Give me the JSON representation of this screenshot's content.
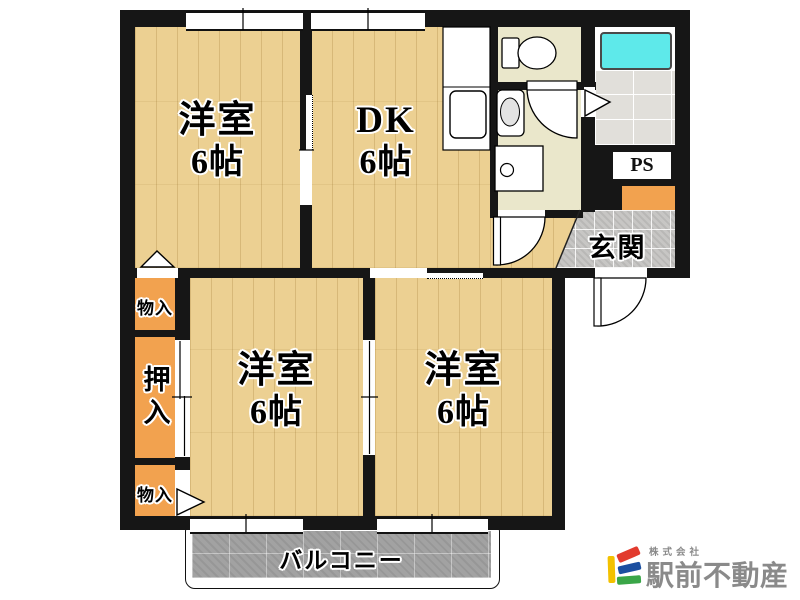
{
  "floor_plan": {
    "rooms": [
      {
        "name": "洋室",
        "size": "6帖",
        "position": "top-left"
      },
      {
        "name": "DK",
        "size": "6帖",
        "position": "top-center"
      },
      {
        "name": "洋室",
        "size": "6帖",
        "position": "bottom-left"
      },
      {
        "name": "洋室",
        "size": "6帖",
        "position": "bottom-center"
      }
    ],
    "entrance_label": "玄関",
    "closet_top_label": "物入",
    "closet_middle_label": "押入",
    "closet_bottom_label": "物入",
    "pipe_space_label": "PS",
    "balcony_label": "バルコニー"
  },
  "branding": {
    "company_prefix": "株式会社",
    "company_name": "駅前不動産",
    "name_color": "#8a8a8a",
    "mark_colors": {
      "yellow": "#f3c100",
      "red": "#e23b2e",
      "blue": "#1b4fa0",
      "green": "#3aa648"
    }
  },
  "palette": {
    "wood_floor": "#ecd092",
    "closet_orange": "#f2a24f",
    "sanitary_beige": "#eae7cb",
    "entrance_tile_gray": "#c7c6c4",
    "bath_tile_gray": "#e1dfda",
    "balcony_gray": "#a2a2a2",
    "bathtub_cyan": "#5ee9ea",
    "wall_black": "#161616"
  }
}
